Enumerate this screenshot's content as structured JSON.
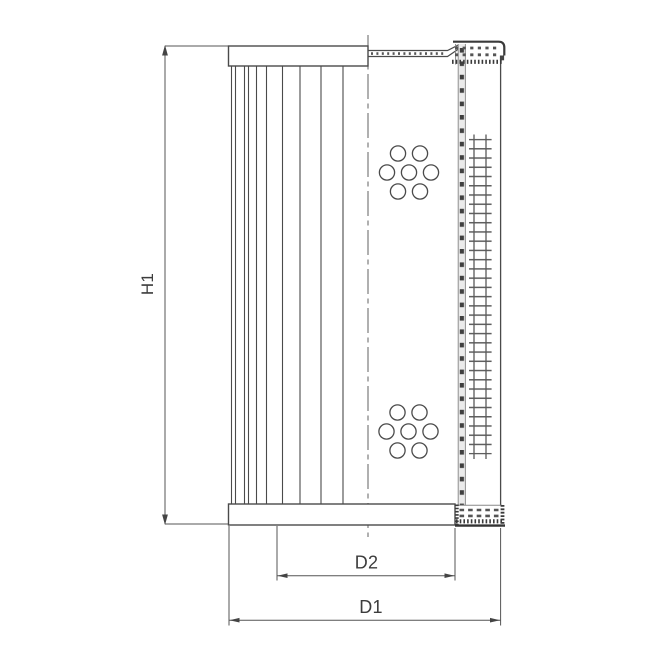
{
  "diagram": {
    "type": "technical-drawing",
    "subject": "filter-element-side-section",
    "labels": {
      "height": "H1",
      "inner_diameter": "D2",
      "outer_diameter": "D1"
    },
    "colors": {
      "background": "#ffffff",
      "line": "#4a4a4a",
      "dimension_line": "#555555",
      "text": "#3d3d3d",
      "mesh": "#5f5f5f",
      "stipple": "#3a3a3a"
    }
  }
}
